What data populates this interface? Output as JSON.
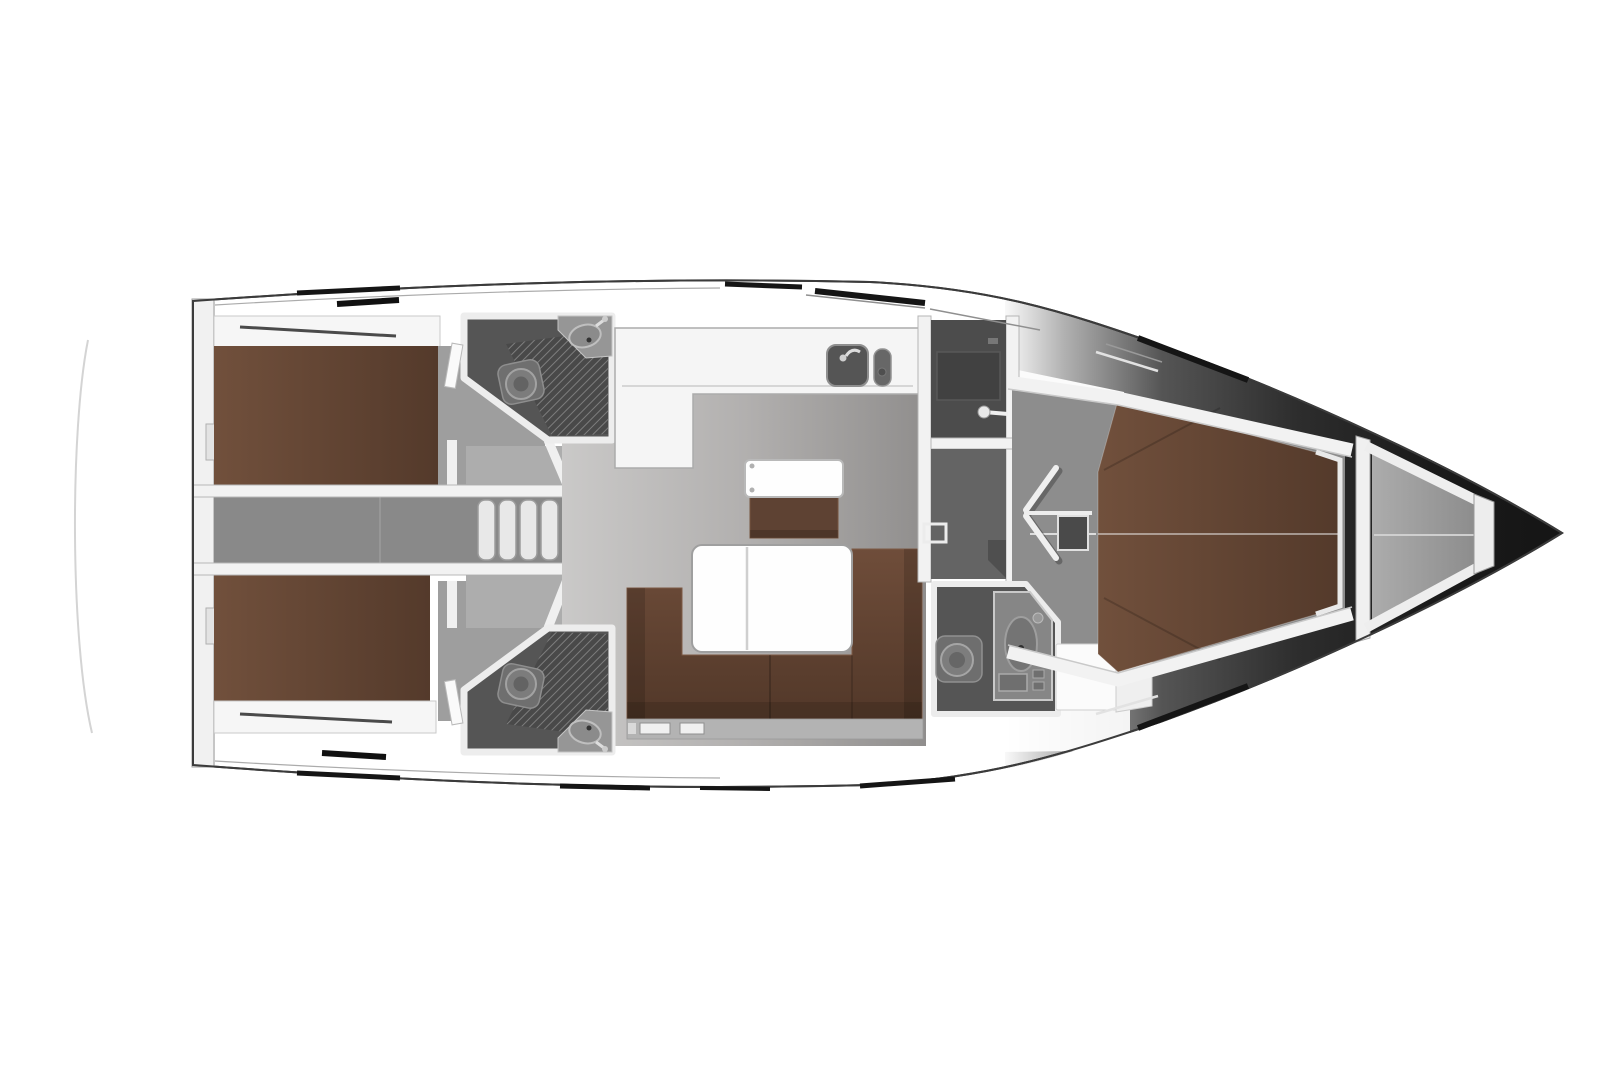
{
  "meta": {
    "diagram_type": "yacht-interior-floor-plan",
    "orientation": "bow-right-stern-left",
    "render_style": "grayscale-3d-top-view-with-brown-upholstery"
  },
  "palette": {
    "hull_outline": "#3b3b3b",
    "wall_white": "#f2f2f2",
    "wall_edge": "#bdbdbd",
    "berth_brown": "#71503c",
    "berth_brown_dark": "#543a2b",
    "sofa_brown": "#6f4d3a",
    "bench_brown": "#5e4233",
    "table_white": "#fefefe",
    "salon_floor": "#b2b0af",
    "corridor_floor": "#898989",
    "cabin_floor": "#9e9e9e",
    "lobby_floor": "#adadad",
    "head_floor": "#555555",
    "shower_floor": "#494949",
    "shower_hatch": "#7e7e7e",
    "fixture_gray": "#7c7c7c",
    "nav_panel": "#4c4c4c",
    "nav_floor": "#646464",
    "fore_floor": "#8d8d8d",
    "anchor_floor": "#acacac",
    "bow_shadow": "#1a1a1a",
    "steps_white": "#e8e8e8",
    "platform_line": "#d4d4d4",
    "under_sofa_strip": "#b3b3b3",
    "counter_white": "#f5f5f5",
    "sink_gray": "#555555"
  },
  "regions": {
    "stern_platform": "swim-platform-faded",
    "aft_cabin_port": "double-berth-cabin",
    "aft_cabin_starboard": "double-berth-cabin",
    "companionway": "entry-steps",
    "aft_head_port": "toilet-shower-basin",
    "aft_head_starboard": "toilet-shower-basin",
    "galley": "l-counter-twin-sinks",
    "saloon": "u-sofa-folding-table-side-bench",
    "nav_station": "chart-table-compartments",
    "wardrobe": "hanging-locker",
    "forward_head": "toilet-vanity-basin-bench",
    "forward_cabin": "double-v-berth",
    "anchor_locker": "bow-stowage",
    "bow": "hull-taper-shadow"
  }
}
